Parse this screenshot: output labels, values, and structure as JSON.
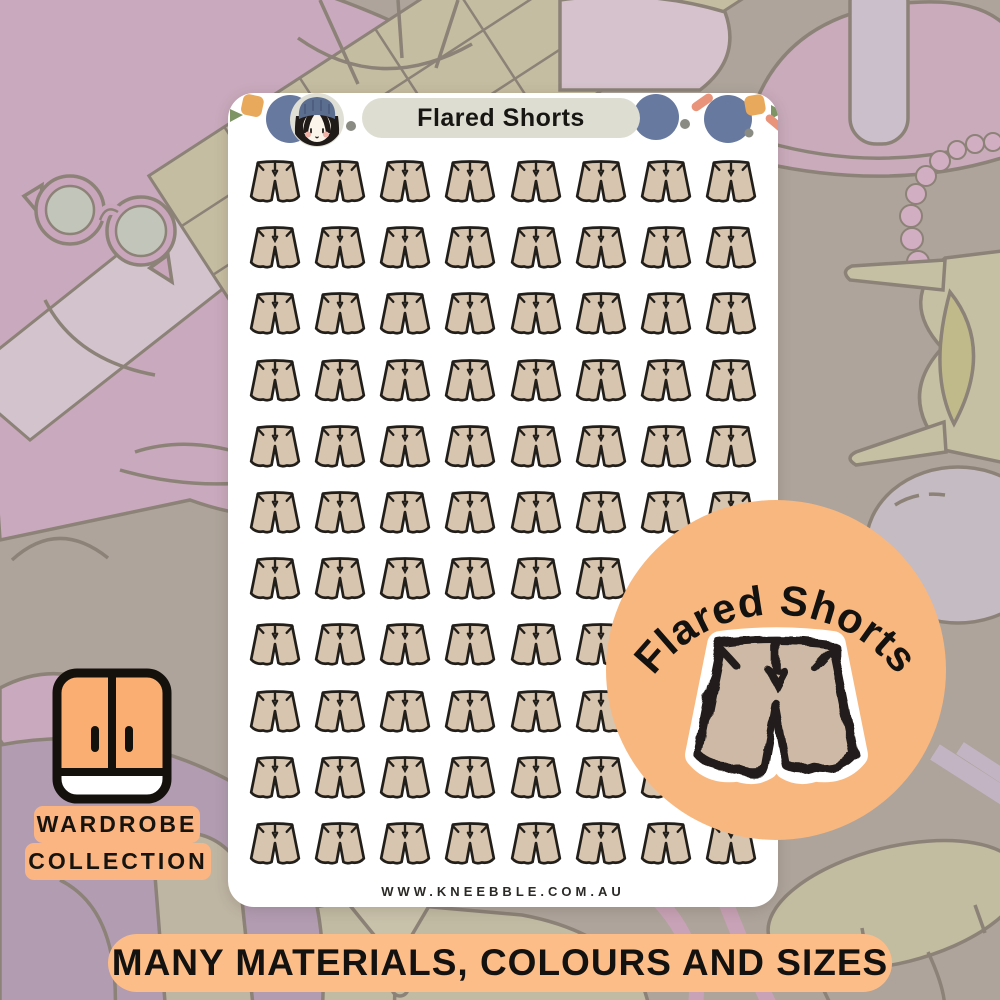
{
  "sheet": {
    "title": "Flared Shorts",
    "website": "WWW.KNEEBBLE.COM.AU",
    "grid": {
      "rows": 11,
      "cols": 8,
      "sticker_count": 88,
      "sticker_name": "flared-shorts-sticker"
    }
  },
  "badge": {
    "label": "Flared Shorts"
  },
  "collection_tag": {
    "line1": "WARDROBE",
    "line2": "COLLECTION"
  },
  "banner": {
    "text": "MANY MATERIALS, COLOURS AND SIZES"
  },
  "icons": {
    "sheet_sticker": "flared-shorts-icon",
    "badge_sticker": "flared-shorts-sticker-large",
    "tag_icon": "wardrobe-cabinet-icon",
    "header_avatar": "girl-avatar-icon",
    "header_confetti": [
      "green-triangle",
      "orange-square",
      "blue-circle",
      "gray-dot",
      "coral-dash"
    ]
  },
  "colors": {
    "background_taupe": "#AEA49B",
    "illustration_outline": "#8C8277",
    "illustration_pink": "#C9A9BD",
    "sheet_bg": "#FFFFFF",
    "title_pill_bg": "#DEDDD2",
    "shorts_fill": "#D8C5AF",
    "ink_black": "#221F1B",
    "badge_orange": "#F8B77E",
    "banner_orange": "#FCBD88",
    "tag_orange": "#FBB583",
    "confetti_blue": "#67799F",
    "confetti_green": "#7E9465",
    "confetti_coral": "#E9937B",
    "confetti_orange": "#E8A95D"
  }
}
